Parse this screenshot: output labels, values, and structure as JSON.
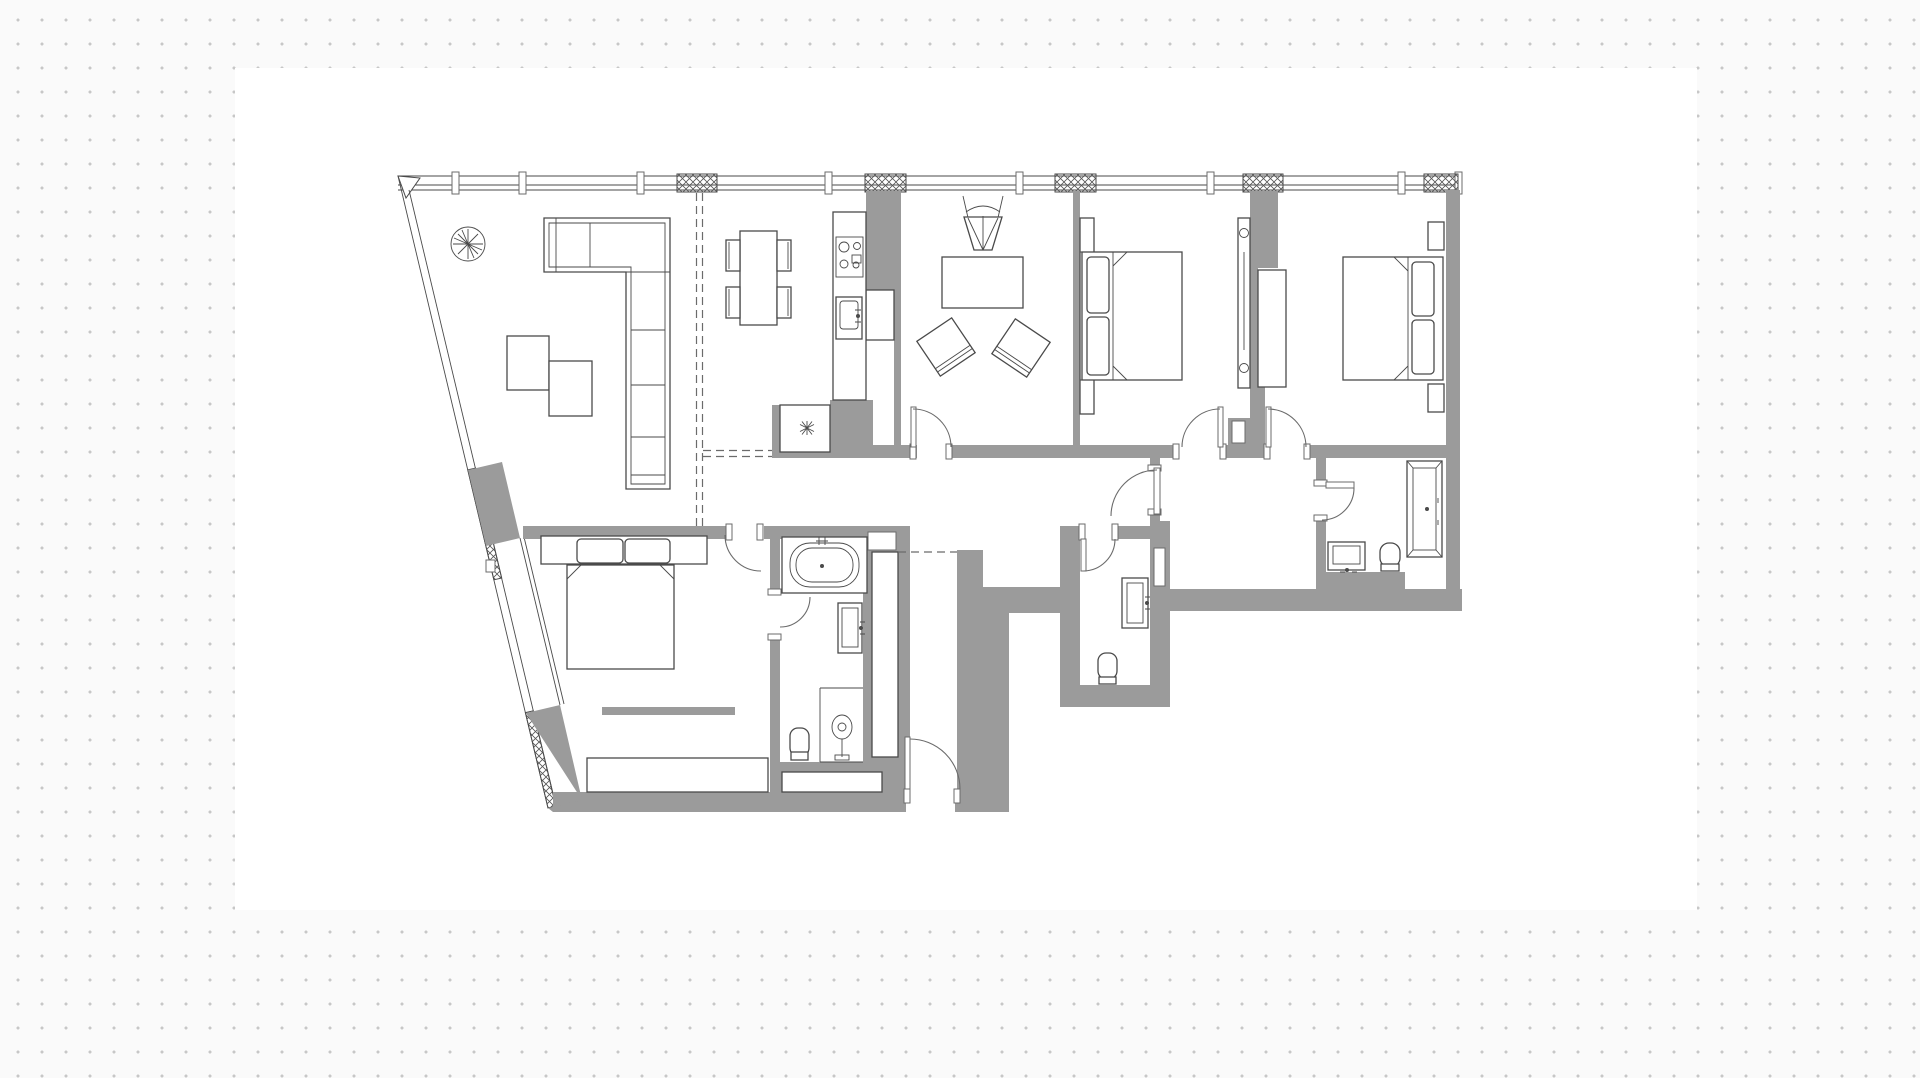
{
  "meta": {
    "kind": "architectural-floor-plan",
    "description": "Black-and-white apartment floor plan drawing placed on a white sheet over a dotted grid background. No text labels are rendered in the image."
  },
  "canvas": {
    "width_px": 1920,
    "height_px": 1078,
    "dot_spacing_px": 24,
    "dot_size_px": 3,
    "paper_rect": {
      "x": 235,
      "y": 68,
      "w": 1462,
      "h": 842
    }
  },
  "palette": {
    "page_bg": "#fafafa",
    "dot": "#c7c7c7",
    "paper": "#ffffff",
    "wall": "#9b9b9b",
    "line": "#4a4a4a",
    "line_soft": "#6b6b6b"
  },
  "plan": {
    "rooms": [
      {
        "name": "living-area",
        "features": [
          "plant-symbol",
          "l-shaped-sofa",
          "coffee-table-pair"
        ]
      },
      {
        "name": "dining-area",
        "features": [
          "dining-table",
          "four-chairs"
        ]
      },
      {
        "name": "kitchen",
        "features": [
          "counter",
          "cooktop",
          "sink",
          "tall-appliance",
          "utility-closet-with-star"
        ]
      },
      {
        "name": "lounge-tv-room",
        "features": [
          "tv-on-stand",
          "table",
          "two-angled-armchairs"
        ]
      },
      {
        "name": "bedroom-center",
        "features": [
          "double-bed",
          "pillows",
          "wardrobe-strip"
        ]
      },
      {
        "name": "bedroom-right",
        "features": [
          "double-bed",
          "pillows",
          "nightstands",
          "built-in-wardrobe",
          "sliding-panel"
        ]
      },
      {
        "name": "bedroom-lower-left",
        "features": [
          "double-bed",
          "headboard-shelf",
          "media-strip",
          "bench-wardrobe"
        ]
      },
      {
        "name": "ensuite-bathroom",
        "features": [
          "bathtub",
          "washbasin",
          "shower",
          "toilet"
        ]
      },
      {
        "name": "wc",
        "features": [
          "washbasin",
          "toilet"
        ]
      },
      {
        "name": "bathroom-right",
        "features": [
          "bathtub",
          "washbasin",
          "toilet"
        ]
      },
      {
        "name": "hallway",
        "features": [
          "door-arcs",
          "dashed-zone-boundaries"
        ]
      },
      {
        "name": "entry-corridor",
        "features": [
          "entry-door",
          "dashed-threshold"
        ]
      },
      {
        "name": "balcony-terrace",
        "features": [
          "glazed-facade",
          "hatched-vent-panels",
          "diagonal-glazing"
        ]
      }
    ],
    "door_count": 9,
    "window_vent_panel_count": 5
  }
}
